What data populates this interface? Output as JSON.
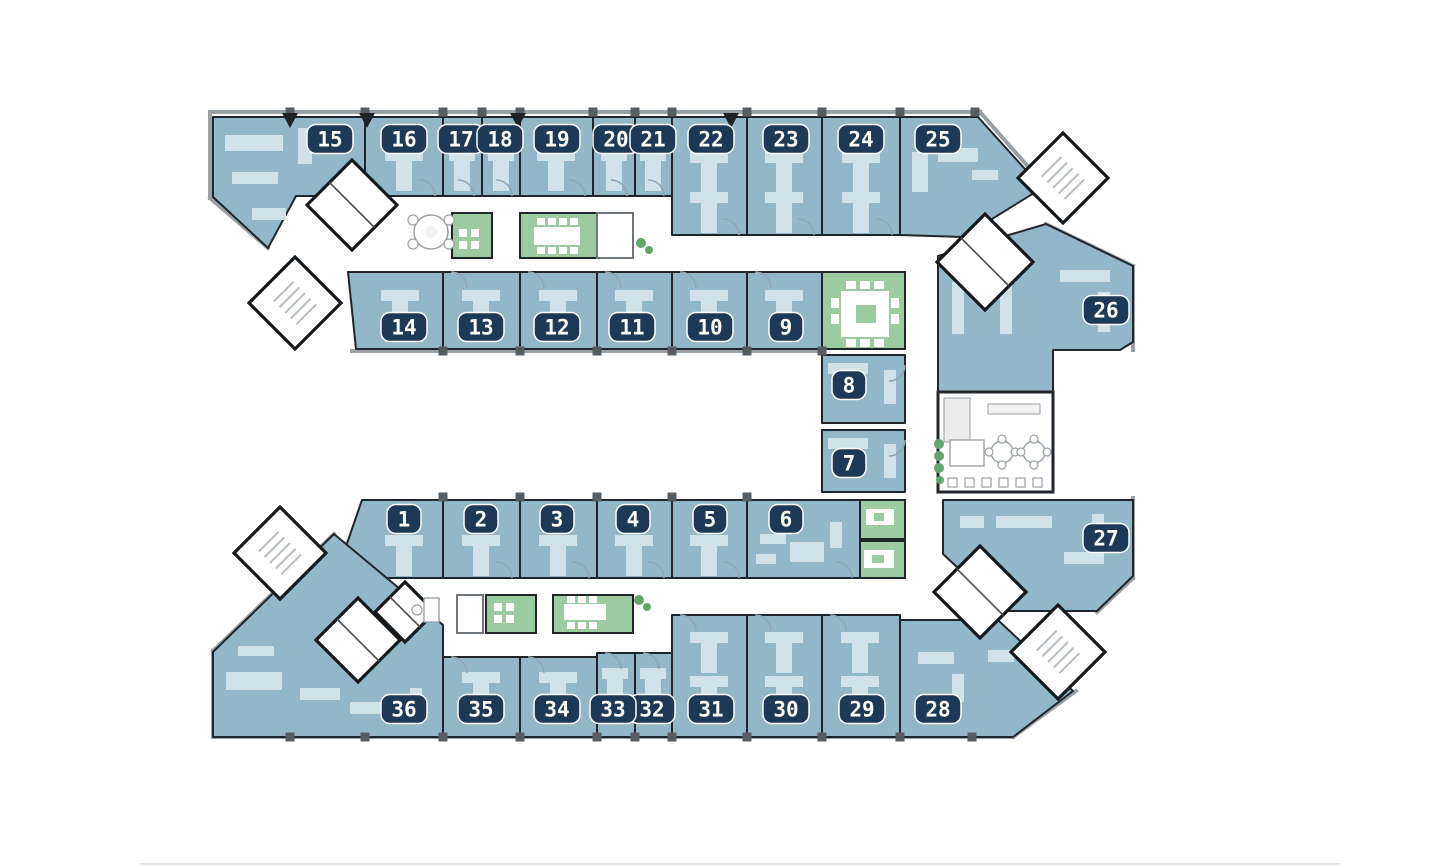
{
  "page": {
    "background_color": "#ffffff"
  },
  "floor_plan": {
    "kind": "office-floor-plan",
    "rooms": [
      {
        "number": "1",
        "category": "office"
      },
      {
        "number": "2",
        "category": "office"
      },
      {
        "number": "3",
        "category": "office"
      },
      {
        "number": "4",
        "category": "office"
      },
      {
        "number": "5",
        "category": "office"
      },
      {
        "number": "6",
        "category": "office"
      },
      {
        "number": "7",
        "category": "office"
      },
      {
        "number": "8",
        "category": "office"
      },
      {
        "number": "9",
        "category": "office"
      },
      {
        "number": "10",
        "category": "office"
      },
      {
        "number": "11",
        "category": "office"
      },
      {
        "number": "12",
        "category": "office"
      },
      {
        "number": "13",
        "category": "office"
      },
      {
        "number": "14",
        "category": "office"
      },
      {
        "number": "15",
        "category": "office"
      },
      {
        "number": "16",
        "category": "office"
      },
      {
        "number": "17",
        "category": "office"
      },
      {
        "number": "18",
        "category": "office"
      },
      {
        "number": "19",
        "category": "office"
      },
      {
        "number": "20",
        "category": "office"
      },
      {
        "number": "21",
        "category": "office"
      },
      {
        "number": "22",
        "category": "office"
      },
      {
        "number": "23",
        "category": "office"
      },
      {
        "number": "24",
        "category": "office"
      },
      {
        "number": "25",
        "category": "office"
      },
      {
        "number": "26",
        "category": "office"
      },
      {
        "number": "27",
        "category": "office"
      },
      {
        "number": "28",
        "category": "office"
      },
      {
        "number": "29",
        "category": "office"
      },
      {
        "number": "30",
        "category": "office"
      },
      {
        "number": "31",
        "category": "office"
      },
      {
        "number": "32",
        "category": "office"
      },
      {
        "number": "33",
        "category": "office"
      },
      {
        "number": "34",
        "category": "office"
      },
      {
        "number": "35",
        "category": "office"
      },
      {
        "number": "36",
        "category": "office"
      }
    ],
    "green_meeting_areas_count": 7,
    "stair_cores_count": 4,
    "wc_cores_count": 5,
    "colors": {
      "office_fill": "#92b7c8",
      "office_furniture": "#cfe2ea",
      "meeting_green": "#9ccba1",
      "meeting_table": "#ffffff",
      "badge_background": "#1c3a57",
      "badge_text": "#ffffff",
      "wall": "#20262b",
      "facade": "#9aa1a5",
      "fixture": "#9aa1a5",
      "plant_green": "#64a56d"
    }
  }
}
